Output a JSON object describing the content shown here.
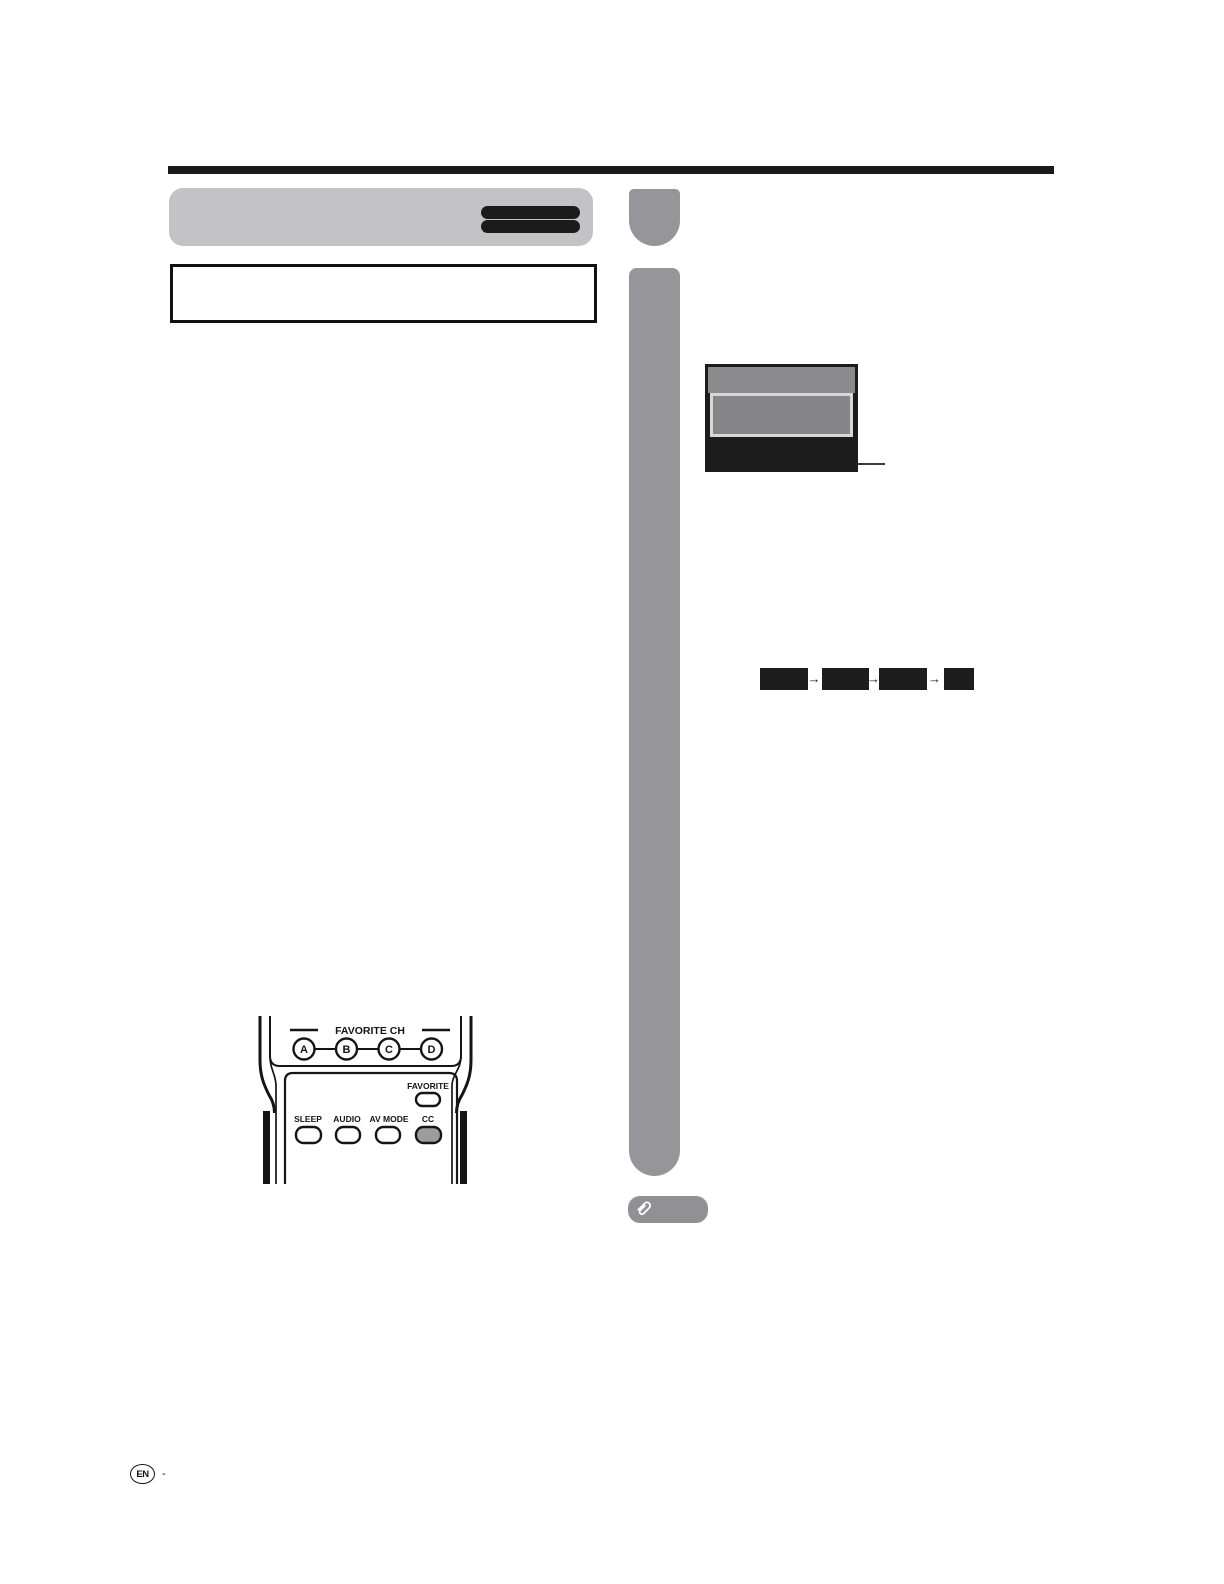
{
  "header": {
    "redaction_pill_count": 2
  },
  "tv_osd": {
    "description": "on-screen display thumbnail with highlighted menu row"
  },
  "cc_sequence": {
    "box_count": 4,
    "arrow_glyph": "→"
  },
  "remote": {
    "group_label": "FAVORITE CH",
    "channel_buttons": [
      "A",
      "B",
      "C",
      "D"
    ],
    "favorite_label": "FAVORITE",
    "function_labels": [
      "SLEEP",
      "AUDIO",
      "AV MODE",
      "CC"
    ],
    "highlighted_button": "CC"
  },
  "note": {
    "icon": "paperclip-icon"
  },
  "footer": {
    "language_badge": "EN",
    "separator": "-"
  },
  "colors": {
    "rule": "#1a1a1a",
    "banner": "#c3c3c5",
    "banner_pill": "#1b1b1b",
    "column_bar": "#96969a",
    "tv_frame": "#1c1c1c",
    "tv_top": "#8b8b8d",
    "tv_highlight_fill": "#85858a",
    "tv_highlight_border": "#d8d8d8",
    "sequence_box": "#1d1d1d",
    "note_tag": "#919195",
    "cc_button_fill": "#9c9c9c"
  }
}
